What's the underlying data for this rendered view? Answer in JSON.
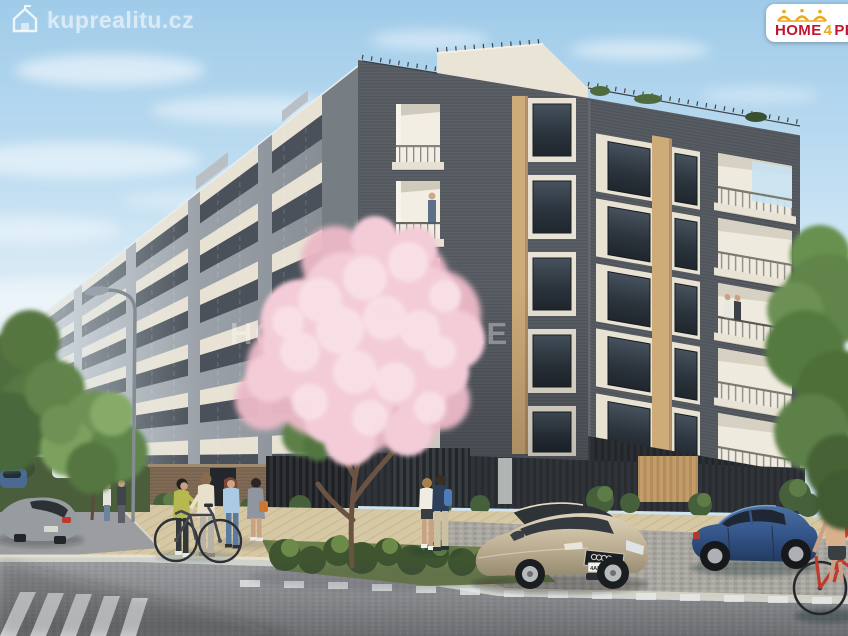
{
  "watermarks": {
    "site_logo_text": "kuprealitu.cz",
    "center_watermark_text": "HOME 4 PEOPLE"
  },
  "logo_badge": {
    "word_home": "HOME",
    "word_number": "4",
    "word_people": "PEOPLE",
    "text_color": "#c01430",
    "accent_color": "#f0a91c",
    "background": "#ffffff",
    "icons": [
      "crown-icon",
      "house-icon"
    ]
  },
  "vehicles": {
    "foreground_car_plate": "4A8 7973"
  },
  "palette": {
    "sky_top": "#9fcbe9",
    "sky_horizon": "#eef4f6",
    "brick_dark": "#5a5f66",
    "facade_light": "#b4bcc2",
    "panel_cream": "#e9e3d5",
    "panel_tan": "#cfab79",
    "blossom_pink": "#f0c9d4",
    "foliage_green": "#6f9355",
    "road_grey": "#797b7e",
    "pavement_beige": "#d7c8a4",
    "audi_champagne": "#c0b398",
    "hatchback_blue": "#34568a",
    "bicycle_red": "#c03a2c"
  }
}
